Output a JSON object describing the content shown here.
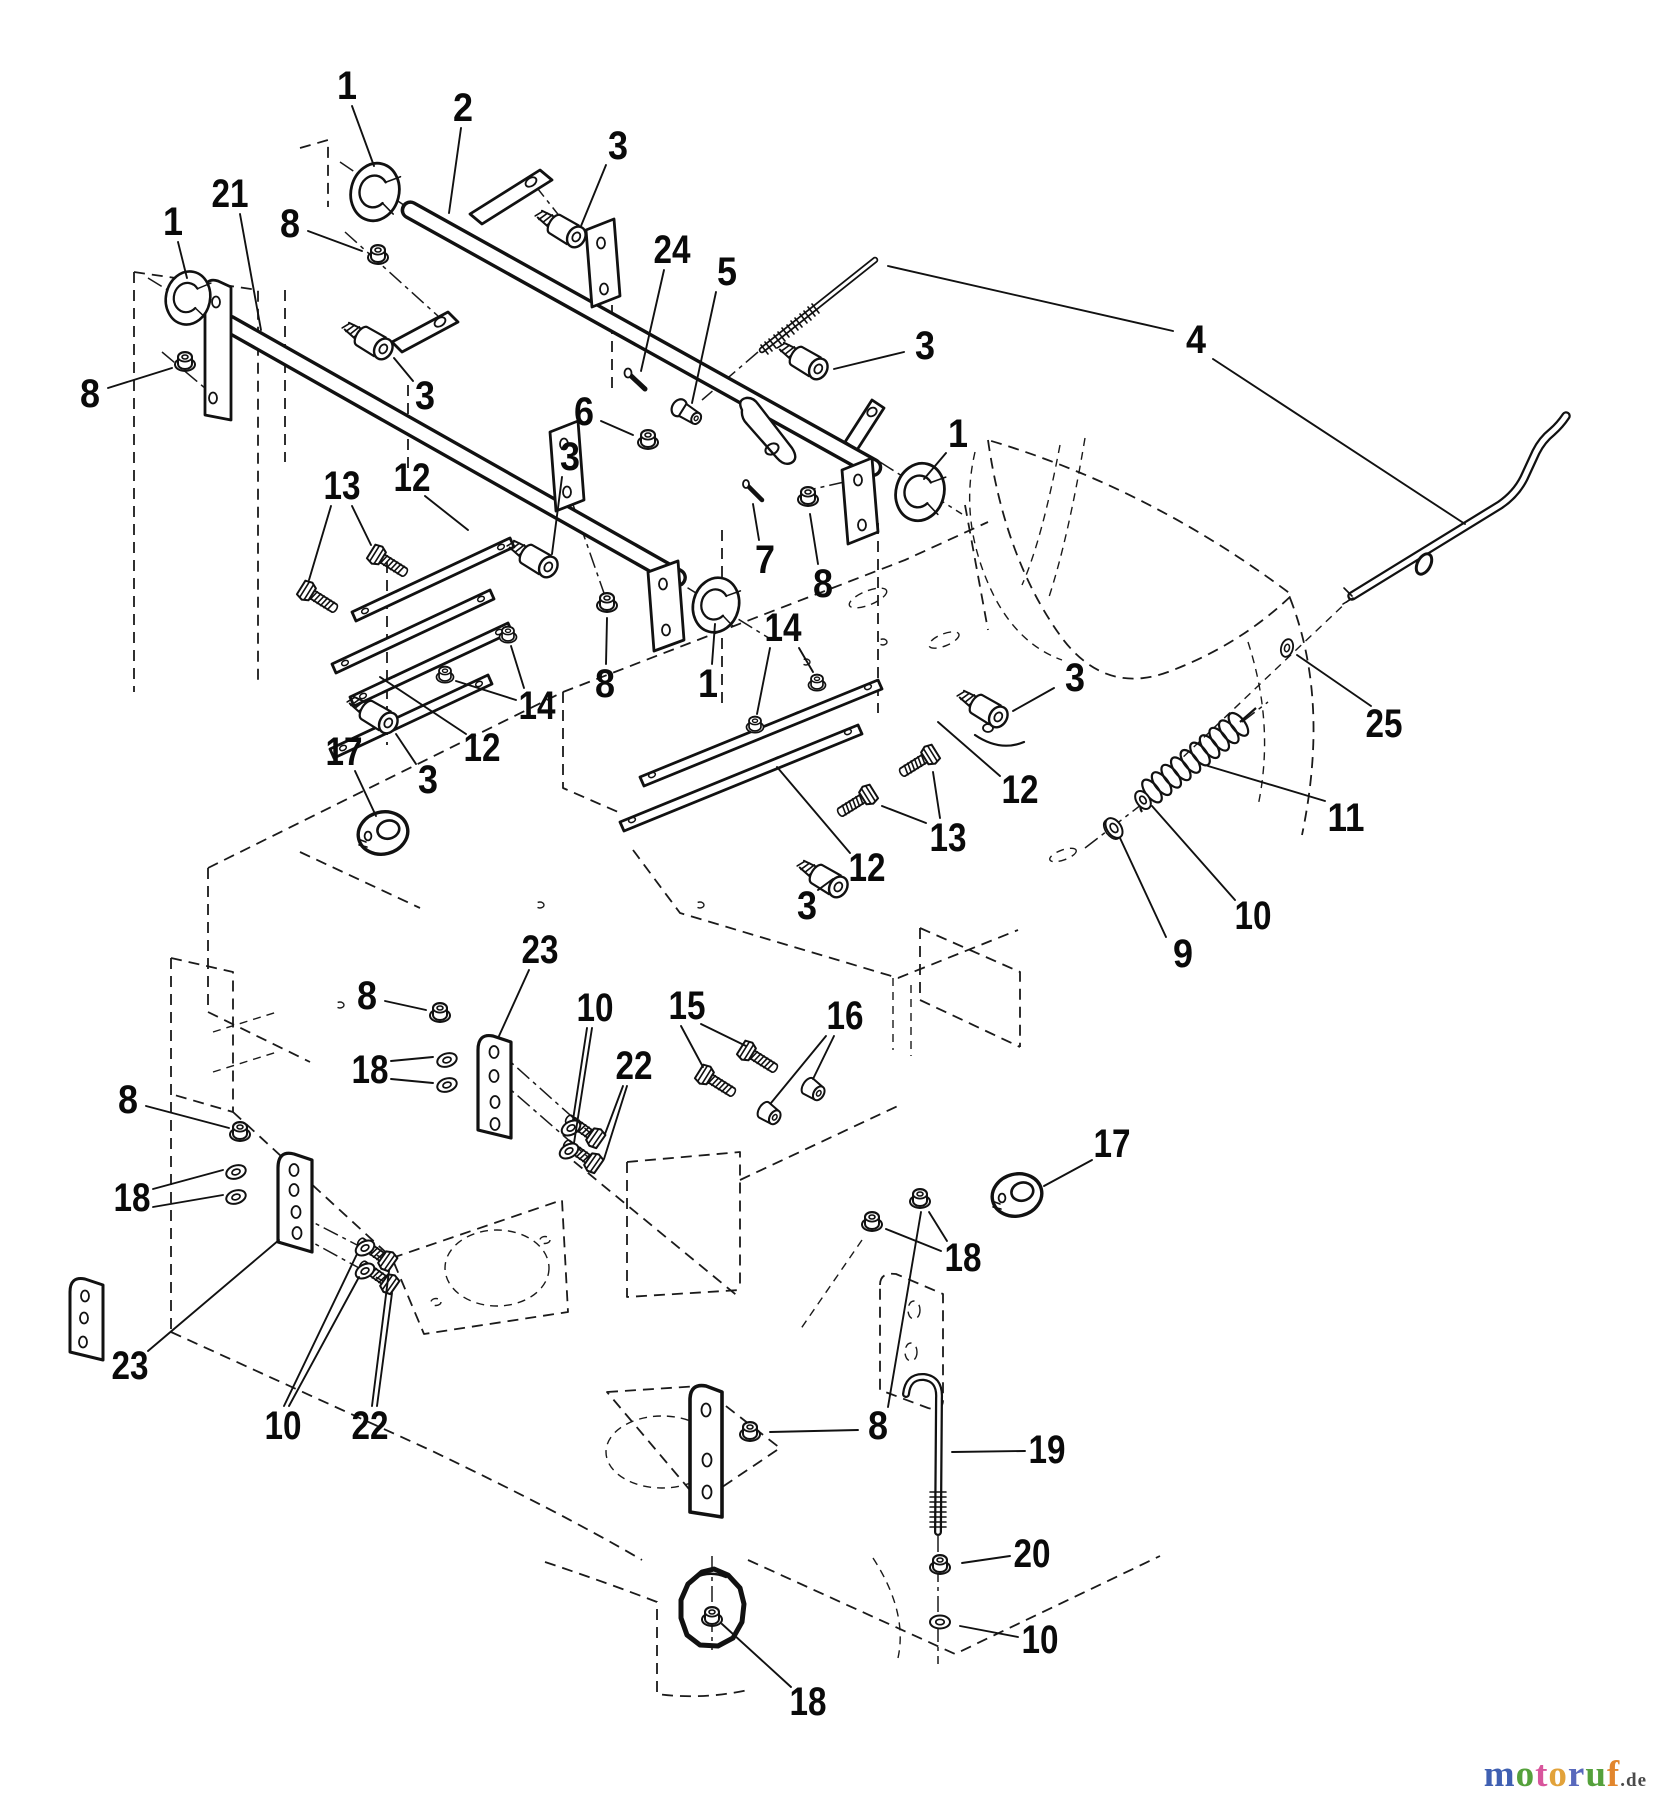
{
  "diagram": {
    "type": "exploded-parts-diagram",
    "line_color": "#111111",
    "background": "#ffffff",
    "callouts": [
      {
        "label": "1",
        "x": 347,
        "y": 86,
        "leaders": [
          [
            352,
            106,
            374,
            166
          ]
        ]
      },
      {
        "label": "2",
        "x": 463,
        "y": 108,
        "leaders": [
          [
            461,
            128,
            449,
            213
          ]
        ]
      },
      {
        "label": "3",
        "x": 618,
        "y": 146,
        "leaders": [
          [
            606,
            165,
            581,
            226
          ]
        ]
      },
      {
        "label": "24",
        "x": 672,
        "y": 250,
        "leaders": [
          [
            664,
            270,
            641,
            371
          ]
        ]
      },
      {
        "label": "5",
        "x": 727,
        "y": 272,
        "leaders": [
          [
            716,
            292,
            692,
            403
          ]
        ]
      },
      {
        "label": "1",
        "x": 173,
        "y": 222,
        "leaders": [
          [
            178,
            242,
            187,
            278
          ]
        ]
      },
      {
        "label": "21",
        "x": 230,
        "y": 194,
        "leaders": [
          [
            240,
            214,
            261,
            330
          ]
        ]
      },
      {
        "label": "8",
        "x": 290,
        "y": 224,
        "leaders": [
          [
            308,
            231,
            362,
            251
          ]
        ]
      },
      {
        "label": "3",
        "x": 425,
        "y": 396,
        "leaders": [
          [
            413,
            381,
            394,
            358
          ]
        ]
      },
      {
        "label": "8",
        "x": 90,
        "y": 394,
        "leaders": [
          [
            108,
            388,
            172,
            368
          ]
        ]
      },
      {
        "label": "6",
        "x": 584,
        "y": 412,
        "leaders": [
          [
            601,
            421,
            633,
            435
          ]
        ]
      },
      {
        "label": "3",
        "x": 925,
        "y": 346,
        "leaders": [
          [
            904,
            352,
            834,
            369
          ]
        ]
      },
      {
        "label": "4",
        "x": 1196,
        "y": 340,
        "leaders": [
          [
            1173,
            331,
            888,
            266
          ],
          [
            1213,
            359,
            1465,
            524
          ]
        ]
      },
      {
        "label": "1",
        "x": 958,
        "y": 434,
        "leaders": [
          [
            946,
            453,
            924,
            479
          ]
        ]
      },
      {
        "label": "8",
        "x": 823,
        "y": 584,
        "leaders": [
          [
            818,
            564,
            810,
            514
          ]
        ]
      },
      {
        "label": "7",
        "x": 765,
        "y": 560,
        "leaders": [
          [
            759,
            540,
            753,
            504
          ]
        ]
      },
      {
        "label": "1",
        "x": 708,
        "y": 684,
        "leaders": [
          [
            712,
            664,
            715,
            624
          ]
        ]
      },
      {
        "label": "14",
        "x": 783,
        "y": 628,
        "leaders": [
          [
            770,
            648,
            757,
            714
          ],
          [
            799,
            648,
            813,
            672
          ]
        ]
      },
      {
        "label": "14",
        "x": 537,
        "y": 706,
        "leaders": [
          [
            524,
            688,
            511,
            646
          ],
          [
            516,
            700,
            456,
            681
          ]
        ]
      },
      {
        "label": "12",
        "x": 412,
        "y": 478,
        "leaders": [
          [
            425,
            496,
            468,
            530
          ]
        ]
      },
      {
        "label": "13",
        "x": 342,
        "y": 486,
        "leaders": [
          [
            352,
            506,
            371,
            545
          ],
          [
            331,
            506,
            309,
            580
          ]
        ]
      },
      {
        "label": "3",
        "x": 570,
        "y": 457,
        "leaders": [
          [
            562,
            477,
            552,
            554
          ]
        ]
      },
      {
        "label": "12",
        "x": 482,
        "y": 748,
        "leaders": [
          [
            466,
            734,
            380,
            677
          ]
        ]
      },
      {
        "label": "3",
        "x": 428,
        "y": 780,
        "leaders": [
          [
            416,
            764,
            396,
            734
          ]
        ]
      },
      {
        "label": "17",
        "x": 344,
        "y": 752,
        "leaders": [
          [
            355,
            771,
            376,
            816
          ]
        ]
      },
      {
        "label": "8",
        "x": 605,
        "y": 684,
        "leaders": [
          [
            606,
            664,
            607,
            618
          ]
        ]
      },
      {
        "label": "12",
        "x": 1020,
        "y": 790,
        "leaders": [
          [
            1000,
            776,
            938,
            722
          ]
        ]
      },
      {
        "label": "12",
        "x": 867,
        "y": 868,
        "leaders": [
          [
            850,
            853,
            777,
            767
          ]
        ]
      },
      {
        "label": "13",
        "x": 948,
        "y": 838,
        "leaders": [
          [
            940,
            818,
            933,
            772
          ],
          [
            926,
            823,
            882,
            806
          ]
        ]
      },
      {
        "label": "3",
        "x": 1075,
        "y": 678,
        "leaders": [
          [
            1054,
            688,
            1013,
            711
          ]
        ]
      },
      {
        "label": "3",
        "x": 807,
        "y": 906,
        "leaders": [
          [
            818,
            890,
            833,
            879
          ]
        ]
      },
      {
        "label": "25",
        "x": 1384,
        "y": 724,
        "leaders": [
          [
            1371,
            706,
            1297,
            655
          ]
        ]
      },
      {
        "label": "11",
        "x": 1346,
        "y": 818,
        "leaders": [
          [
            1325,
            801,
            1208,
            766
          ]
        ]
      },
      {
        "label": "10",
        "x": 1253,
        "y": 916,
        "leaders": [
          [
            1235,
            900,
            1152,
            806
          ]
        ]
      },
      {
        "label": "9",
        "x": 1183,
        "y": 954,
        "leaders": [
          [
            1166,
            937,
            1120,
            838
          ]
        ]
      },
      {
        "label": "23",
        "x": 540,
        "y": 950,
        "leaders": [
          [
            529,
            970,
            499,
            1036
          ]
        ]
      },
      {
        "label": "8",
        "x": 367,
        "y": 996,
        "leaders": [
          [
            385,
            1001,
            426,
            1010
          ]
        ]
      },
      {
        "label": "18",
        "x": 370,
        "y": 1070,
        "leaders": [
          [
            391,
            1061,
            433,
            1057
          ],
          [
            391,
            1079,
            433,
            1083
          ]
        ]
      },
      {
        "label": "10",
        "x": 595,
        "y": 1008,
        "leaders": [
          [
            587,
            1028,
            573,
            1120
          ],
          [
            592,
            1028,
            574,
            1143
          ]
        ]
      },
      {
        "label": "22",
        "x": 634,
        "y": 1066,
        "leaders": [
          [
            623,
            1086,
            605,
            1134
          ],
          [
            627,
            1086,
            604,
            1159
          ]
        ]
      },
      {
        "label": "15",
        "x": 687,
        "y": 1006,
        "leaders": [
          [
            701,
            1024,
            746,
            1046
          ],
          [
            681,
            1026,
            703,
            1067
          ]
        ]
      },
      {
        "label": "16",
        "x": 845,
        "y": 1016,
        "leaders": [
          [
            834,
            1036,
            813,
            1079
          ],
          [
            826,
            1036,
            771,
            1103
          ]
        ]
      },
      {
        "label": "8",
        "x": 128,
        "y": 1100,
        "leaders": [
          [
            146,
            1106,
            229,
            1128
          ]
        ]
      },
      {
        "label": "18",
        "x": 132,
        "y": 1198,
        "leaders": [
          [
            153,
            1189,
            223,
            1170
          ],
          [
            153,
            1207,
            223,
            1195
          ]
        ]
      },
      {
        "label": "17",
        "x": 1112,
        "y": 1144,
        "leaders": [
          [
            1092,
            1160,
            1044,
            1186
          ]
        ]
      },
      {
        "label": "18",
        "x": 963,
        "y": 1258,
        "leaders": [
          [
            947,
            1241,
            929,
            1212
          ],
          [
            941,
            1251,
            886,
            1229
          ]
        ]
      },
      {
        "label": "23",
        "x": 130,
        "y": 1366,
        "leaders": [
          [
            148,
            1351,
            279,
            1240
          ]
        ]
      },
      {
        "label": "10",
        "x": 283,
        "y": 1426,
        "leaders": [
          [
            284,
            1406,
            357,
            1254
          ],
          [
            289,
            1406,
            359,
            1277
          ]
        ]
      },
      {
        "label": "22",
        "x": 370,
        "y": 1426,
        "leaders": [
          [
            372,
            1406,
            389,
            1271
          ],
          [
            377,
            1406,
            392,
            1293
          ]
        ]
      },
      {
        "label": "8",
        "x": 878,
        "y": 1426,
        "leaders": [
          [
            858,
            1430,
            770,
            1432
          ],
          [
            888,
            1407,
            921,
            1212
          ]
        ]
      },
      {
        "label": "19",
        "x": 1047,
        "y": 1450,
        "leaders": [
          [
            1025,
            1451,
            952,
            1452
          ]
        ]
      },
      {
        "label": "20",
        "x": 1032,
        "y": 1554,
        "leaders": [
          [
            1010,
            1556,
            962,
            1563
          ]
        ]
      },
      {
        "label": "10",
        "x": 1040,
        "y": 1640,
        "leaders": [
          [
            1018,
            1637,
            960,
            1626
          ]
        ]
      },
      {
        "label": "18",
        "x": 808,
        "y": 1702,
        "leaders": [
          [
            791,
            1687,
            722,
            1624
          ]
        ]
      }
    ],
    "watermark": {
      "letters": [
        {
          "ch": "m",
          "color": "#4060b2"
        },
        {
          "ch": "o",
          "color": "#55a13c"
        },
        {
          "ch": "t",
          "color": "#d8559c"
        },
        {
          "ch": "o",
          "color": "#e2a23a"
        },
        {
          "ch": "r",
          "color": "#5868bc"
        },
        {
          "ch": "u",
          "color": "#55a13c"
        },
        {
          "ch": "f",
          "color": "#e2862d"
        }
      ],
      "suffix": ".de",
      "suffix_color": "#4a4a4a"
    }
  }
}
